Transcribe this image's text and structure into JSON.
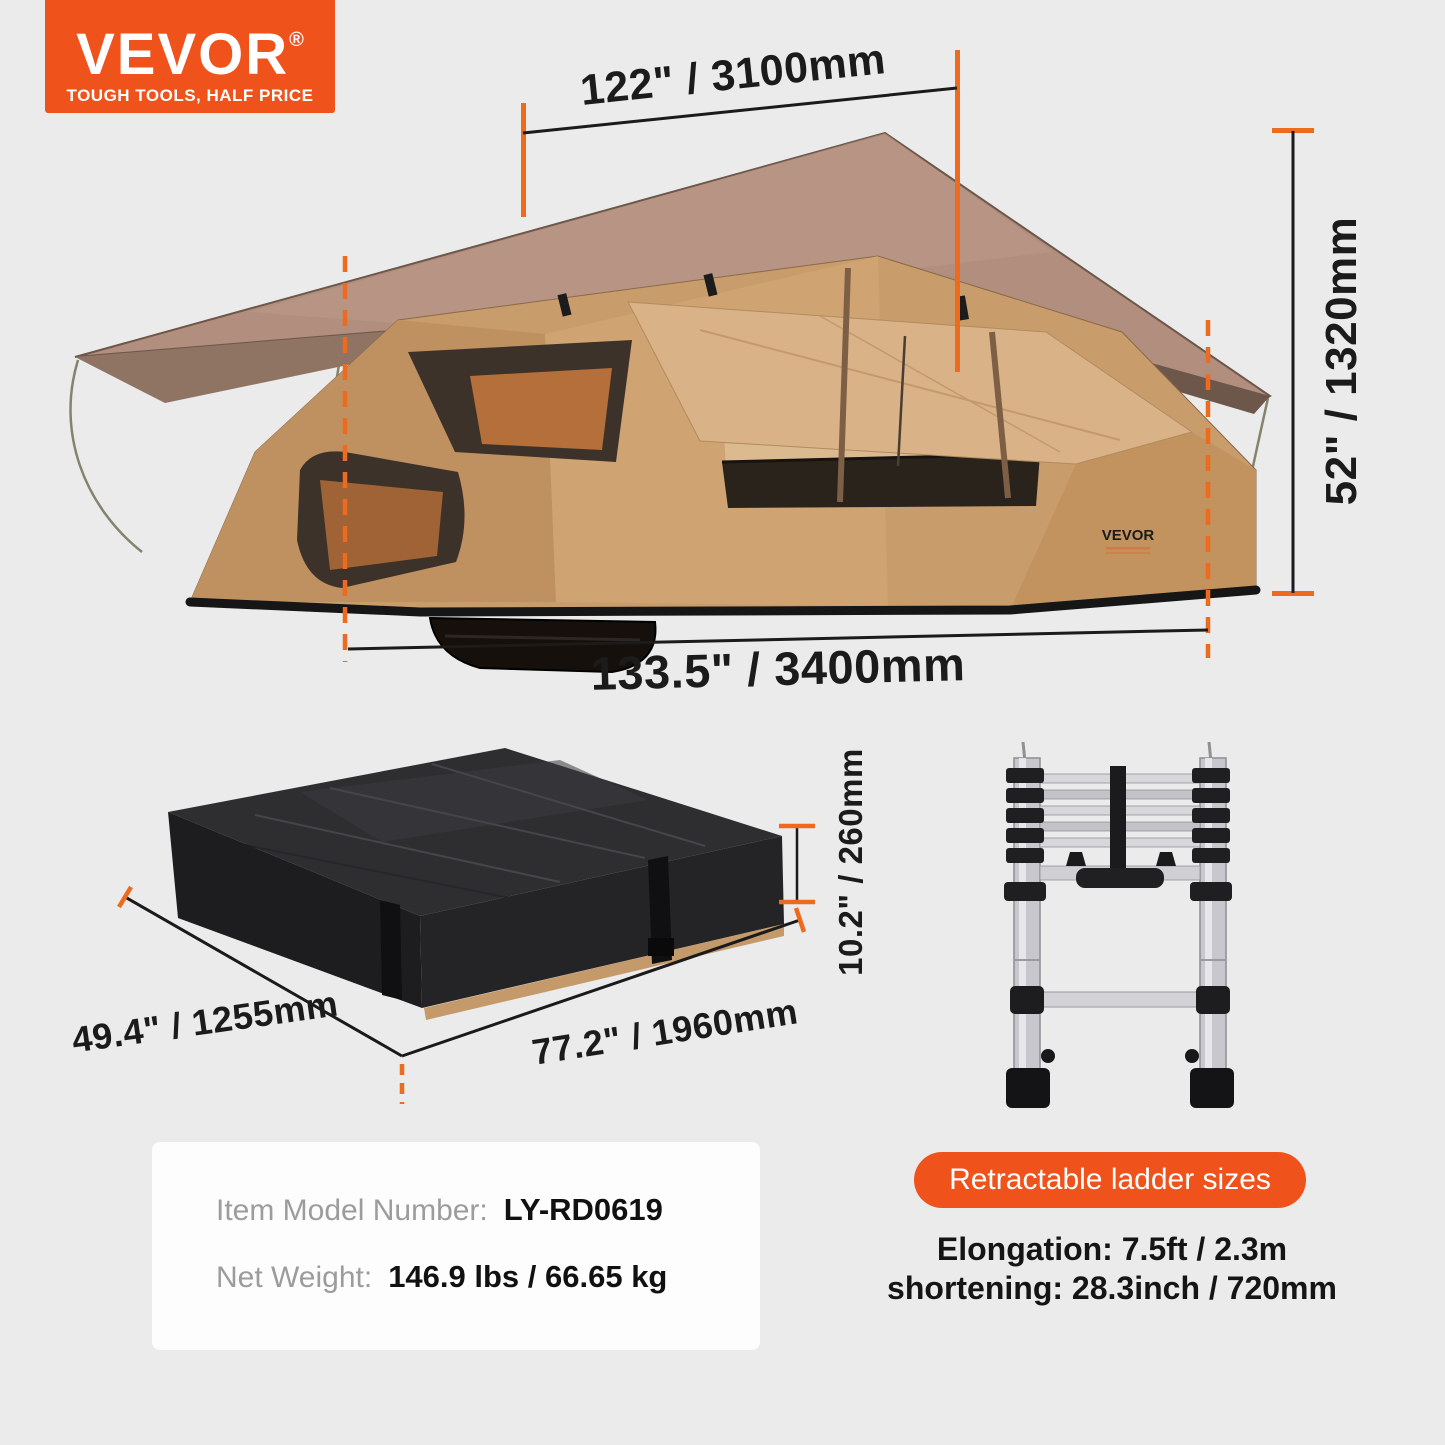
{
  "colors": {
    "background": "#ebebeb",
    "accent": "#f0521c",
    "dimension_tick": "#ed6b1e"
  },
  "logo": {
    "brand": "VEVOR",
    "registered": "®",
    "tagline": "TOUGH TOOLS, HALF PRICE"
  },
  "tent_diagram": {
    "width_top": "122\" / 3100mm",
    "height_side": "52\" / 1320mm",
    "length_bottom": "133.5\" / 3400mm",
    "fabric_logo": "VEVOR"
  },
  "package_diagram": {
    "width": "49.4\" / 1255mm",
    "length": "77.2\" / 1960mm",
    "height": "10.2\" / 260mm"
  },
  "spec_box": {
    "model_label": "Item Model Number:",
    "model_value": "LY-RD0619",
    "weight_label": "Net Weight:",
    "weight_value": "146.9 lbs / 66.65 kg"
  },
  "ladder_info": {
    "badge": "Retractable ladder sizes",
    "elongation": "Elongation: 7.5ft / 2.3m",
    "shortening": "shortening: 28.3inch / 720mm"
  }
}
